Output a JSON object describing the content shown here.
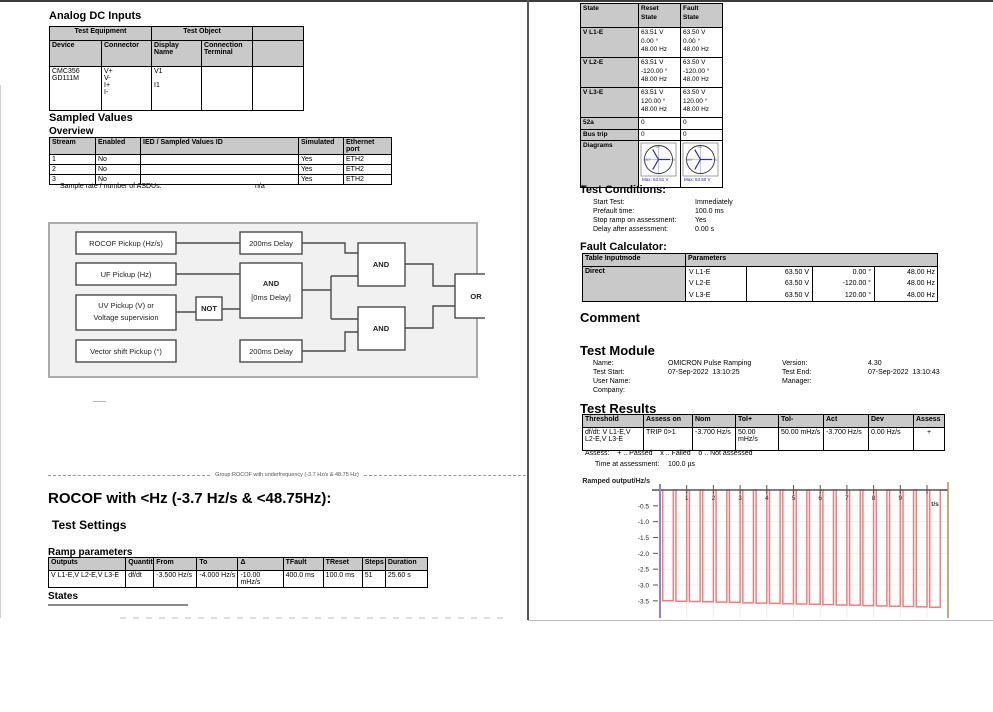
{
  "left": {
    "analog": {
      "title": "Analog DC Inputs",
      "group_headers": [
        "Test Equipment",
        "Test Object"
      ],
      "headers": [
        "Device",
        "Connector",
        "Display Name",
        "Connection Terminal"
      ],
      "row": {
        "device": "CMC356\nGD111M",
        "connector": "V+\nV-\nI+\nI-",
        "display_name": "V1\n\nI1",
        "connection_terminal": ""
      }
    },
    "sampled_values": {
      "title": "Sampled Values",
      "subtitle": "Overview",
      "headers": [
        "Stream",
        "Enabled",
        "IED / Sampled Values ID",
        "Simulated",
        "Ethernet port"
      ],
      "rows": [
        [
          "1",
          "No",
          "",
          "Yes",
          "ETH2"
        ],
        [
          "2",
          "No",
          "",
          "Yes",
          "ETH2"
        ],
        [
          "3",
          "No",
          "",
          "Yes",
          "ETH2"
        ]
      ],
      "sample_rate_label": "Sample rate / number of ASDUs:",
      "sample_rate_value": "n/a"
    },
    "logic_diagram": {
      "rocof": "ROCOF Pickup (Hz/s)",
      "delay_top": "200ms Delay",
      "uf": "UF Pickup (Hz)",
      "and_mid_1": "AND",
      "and_mid_2": "[0ms Delay]",
      "uv_1": "UV Pickup (V) or",
      "uv_2": "Voltage supervision",
      "not": "NOT",
      "vector": "Vector shift Pickup (°)",
      "delay_bottom": "200ms Delay",
      "and_top": "AND",
      "and_bottom": "AND",
      "or": "OR"
    },
    "group_divider": "Group:ROCOF with underfrequency (-3.7 Hz/s & 48.75 Hz)",
    "section_title": "ROCOF with <Hz (-3.7 Hz/s & <48.75Hz):",
    "test_settings_title": "Test Settings",
    "ramp": {
      "title": "Ramp parameters",
      "headers": [
        "Outputs",
        "Quantity",
        "From",
        "To",
        "Δ",
        "TFault",
        "TReset",
        "Steps",
        "Duration"
      ],
      "row": [
        "V L1-E,V L2-E,V L3-E",
        "df/dt",
        "-3.500 Hz/s",
        "-4.000 Hz/s",
        "-10.00 mHz/s",
        "400.0 ms",
        "100.0 ms",
        "51",
        "25.60 s"
      ]
    },
    "states_title": "States"
  },
  "right": {
    "state_table": {
      "headers": [
        "State",
        "Reset\nState",
        "Fault\nState"
      ],
      "rows": [
        {
          "label": "V L1-E",
          "reset": "63.51 V\n0.00 °\n48.00 Hz",
          "fault": "63.50 V\n0.00 °\n48.00 Hz"
        },
        {
          "label": "V L2-E",
          "reset": "63.51 V\n-120.00 °\n48.00 Hz",
          "fault": "63.50 V\n-120.00 °\n48.00 Hz"
        },
        {
          "label": "V L3-E",
          "reset": "63.51 V\n120.00 °\n48.00 Hz",
          "fault": "63.50 V\n120.00 °\n48.00 Hz"
        }
      ],
      "binary_rows": [
        {
          "label": "52a",
          "reset": "0",
          "fault": "0"
        },
        {
          "label": "Bus trip",
          "reset": "0",
          "fault": "0"
        }
      ],
      "diagrams_label": "Diagrams",
      "phasor": {
        "top_label": "90°",
        "left_label": "180°",
        "right_label": "0",
        "reset_caption": "Max: 63.51 V",
        "fault_caption": "Max: 63.50 V",
        "vector_color": "#2a2ace"
      }
    },
    "test_conditions": {
      "title": "Test Conditions:",
      "rows": [
        {
          "label": "Start Test:",
          "value": "Immediately"
        },
        {
          "label": "Prefault time:",
          "value": "100.0 ms"
        },
        {
          "label": "Stop ramp on assessment:",
          "value": "Yes"
        },
        {
          "label": "Delay after assessment:",
          "value": "0.00 s"
        }
      ]
    },
    "fault_calculator": {
      "title": "Fault Calculator:",
      "headers": [
        "Table Inputmode",
        "Parameters"
      ],
      "mode": "Direct",
      "rows": [
        [
          "V L1-E",
          "63.50 V",
          "0.00 °",
          "48.00 Hz"
        ],
        [
          "V L2-E",
          "63.50 V",
          "-120.00 °",
          "48.00 Hz"
        ],
        [
          "V L3-E",
          "63.50 V",
          "120.00 °",
          "48.00 Hz"
        ]
      ]
    },
    "comment_title": "Comment",
    "test_module": {
      "title": "Test Module",
      "rows": [
        {
          "l1": "Name:",
          "v1": "OMICRON Pulse Ramping",
          "l2": "Version:",
          "v2": "4.30"
        },
        {
          "l1": "Test Start:",
          "v1": "07-Sep-2022  13:10:25",
          "l2": "Test End:",
          "v2": "07-Sep-2022  13:10:43"
        },
        {
          "l1": "User Name:",
          "v1": "",
          "l2": "Manager:",
          "v2": ""
        },
        {
          "l1": "Company:",
          "v1": "",
          "l2": "",
          "v2": ""
        }
      ]
    },
    "test_results": {
      "title": "Test Results",
      "headers": [
        "Threshold",
        "Assess on",
        "Nom",
        "Tol+",
        "Tol-",
        "Act",
        "Dev",
        "Assess"
      ],
      "row": [
        "df/dt: V L1-E,V L2-E,V L3-E",
        "TRIP 0>1",
        "-3.700 Hz/s",
        "50.00 mHz/s",
        "50.00 mHz/s",
        "-3.700 Hz/s",
        "0.00 Hz/s",
        "+"
      ],
      "legend": "Assess:    + .. Passed    x .. Failed    o .. Not assessed",
      "time_label": "Time at assessment:",
      "time_value": "100.0 µs"
    }
  },
  "chart_data": {
    "type": "line",
    "title": "Ramped output/Hz/s",
    "xlabel": "t/s",
    "ylabel": "",
    "x_ticks": [
      1,
      2,
      3,
      4,
      5,
      6,
      7,
      8,
      9
    ],
    "y_ticks": [
      -0.5,
      -1.0,
      -1.5,
      -2.0,
      -2.5,
      -3.0,
      -3.5
    ],
    "xlim": [
      0,
      10.8
    ],
    "ylim": [
      -3.8,
      0.2
    ],
    "grid": true,
    "reset_value": 0,
    "reset_duration_s": 0.1,
    "fault_duration_s": 0.4,
    "pulse_depths": [
      -3.5,
      -3.51,
      -3.52,
      -3.53,
      -3.54,
      -3.55,
      -3.56,
      -3.57,
      -3.58,
      -3.59,
      -3.6,
      -3.61,
      -3.62,
      -3.63,
      -3.64,
      -3.65,
      -3.66,
      -3.67,
      -3.68,
      -3.69,
      -3.7
    ],
    "colors": {
      "waveform": "#ef7e7e",
      "left_axis": "#9b7fc0",
      "right_edge": "#b08d62",
      "top_axis": "#555555",
      "grid": "#ebebeb"
    }
  }
}
